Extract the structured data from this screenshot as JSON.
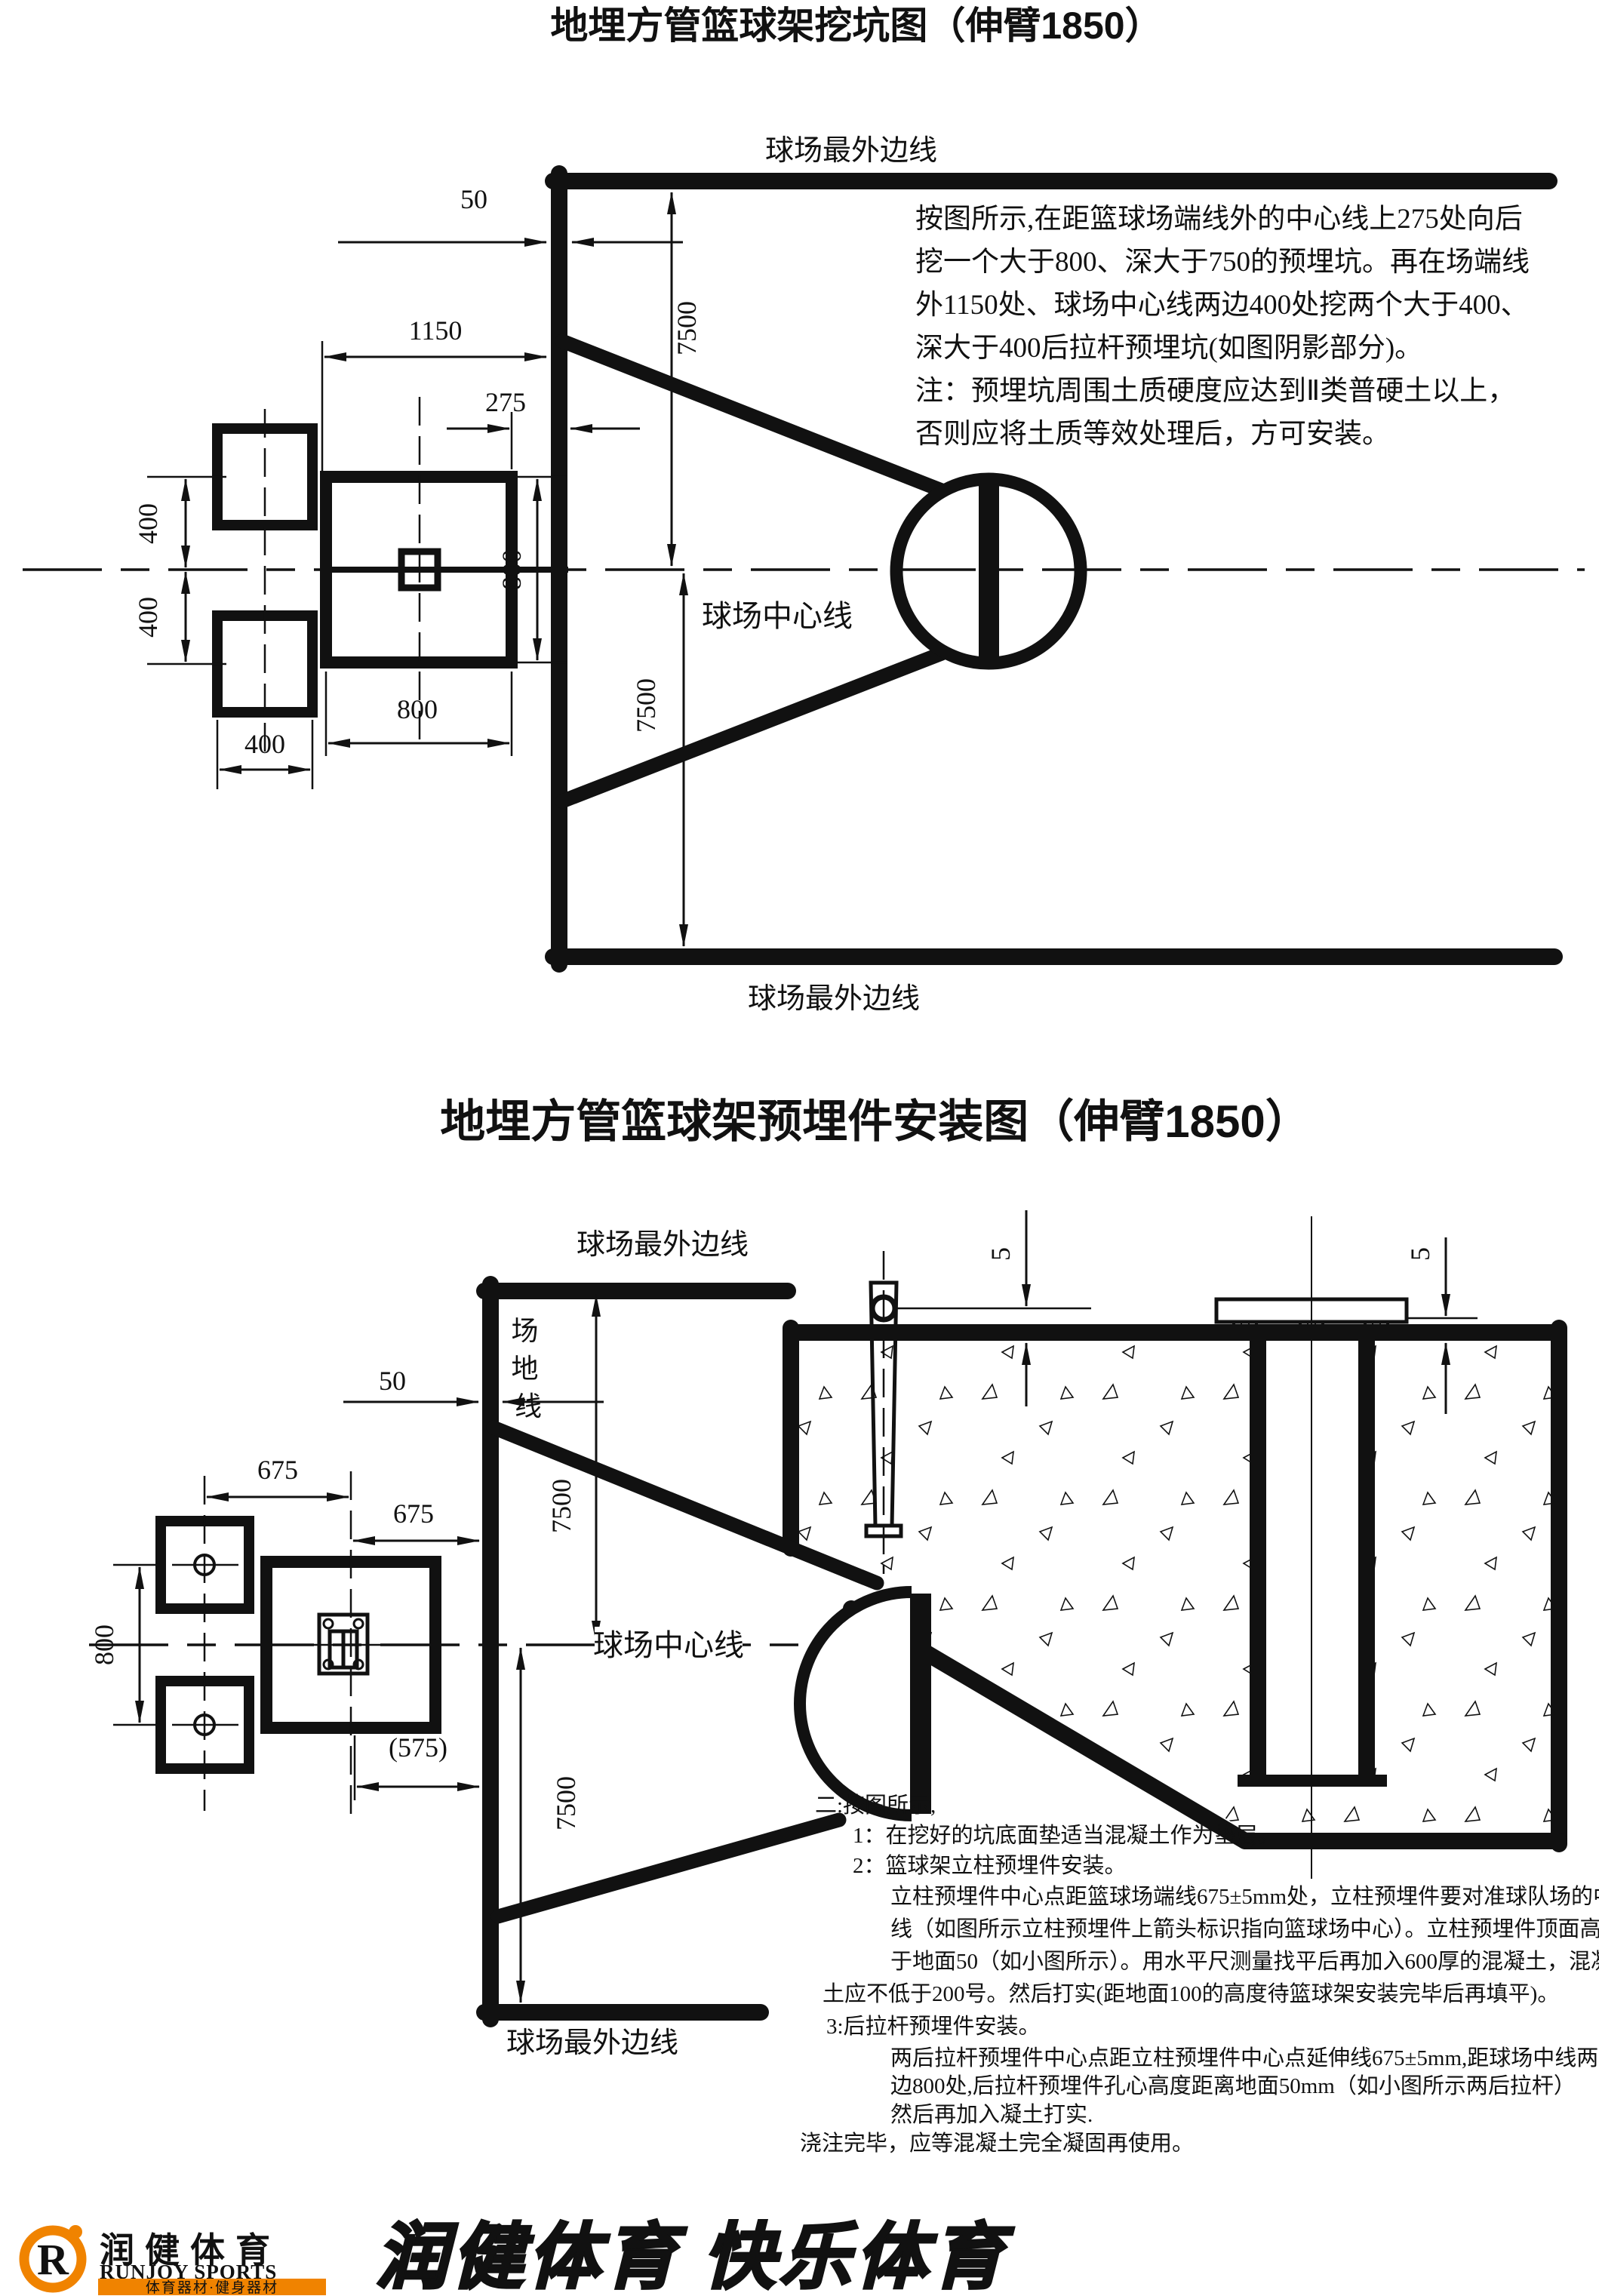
{
  "diagram1": {
    "title": "地埋方管篮球架挖坑图（伸臂1850）",
    "labels": {
      "outer_line": "球场最外边线",
      "center_line": "球场中心线"
    },
    "dims": {
      "d50": "50",
      "d7500": "7500",
      "d1150": "1150",
      "d275": "275",
      "d400": "400",
      "d800": "800"
    },
    "note_lines": [
      "按图所示,在距篮球场端线外的中心线上275处向后",
      "挖一个大于800、深大于750的预埋坑。再在场端线",
      "外1150处、球场中心线两边400处挖两个大于400、",
      "深大于400后拉杆预埋坑(如图阴影部分)。",
      "注：预埋坑周围土质硬度应达到Ⅱ类普硬土以上，",
      "否则应将土质等效处理后，方可安装。"
    ]
  },
  "diagram2": {
    "title": "地埋方管篮球架预埋件安装图（伸臂1850）",
    "labels": {
      "outer_line": "球场最外边线",
      "center_line": "球场中心线",
      "field_line_chars": [
        "场",
        "地",
        "线"
      ]
    },
    "dims": {
      "d50": "50",
      "d675": "675",
      "d800": "800",
      "d575": "(575)",
      "d7500": "7500",
      "d5": "5"
    },
    "note_lines": [
      "二:按图所示,",
      "1：在挖好的坑底面垫适当混凝土作为垫层。",
      "2：篮球架立柱预埋件安装。",
      "立柱预埋件中心点距篮球场端线675±5mm处，立柱预埋件要对准球队场的中",
      "线（如图所示立柱预埋件上箭头标识指向篮球场中心）。立柱预埋件顶面高",
      "于地面50（如小图所示）。用水平尺测量找平后再加入600厚的混凝土，混凝",
      "土应不低于200号。然后打实(距地面100的高度待篮球架安装完毕后再填平)。",
      "3:后拉杆预埋件安装。",
      "两后拉杆预埋件中心点距立柱预埋件中心点延伸线675±5mm,距球场中线两",
      "边800处,后拉杆预埋件孔心高度距离地面50mm（如小图所示两后拉杆）",
      "然后再加入凝土打实.",
      "浇注完毕，应等混凝土完全凝固再使用。"
    ]
  },
  "footer": {
    "brand_cn": "润健体育",
    "brand_en": "RUNJOY SPORTS",
    "brand_sub": "体育器材·健身器材",
    "brand_logo_letter": "R",
    "slogan": "润健体育 快乐体育",
    "colors": {
      "orange": "#f08300",
      "red": "#e23a00",
      "blue": "#2a5caa",
      "ink": "#111111"
    }
  }
}
